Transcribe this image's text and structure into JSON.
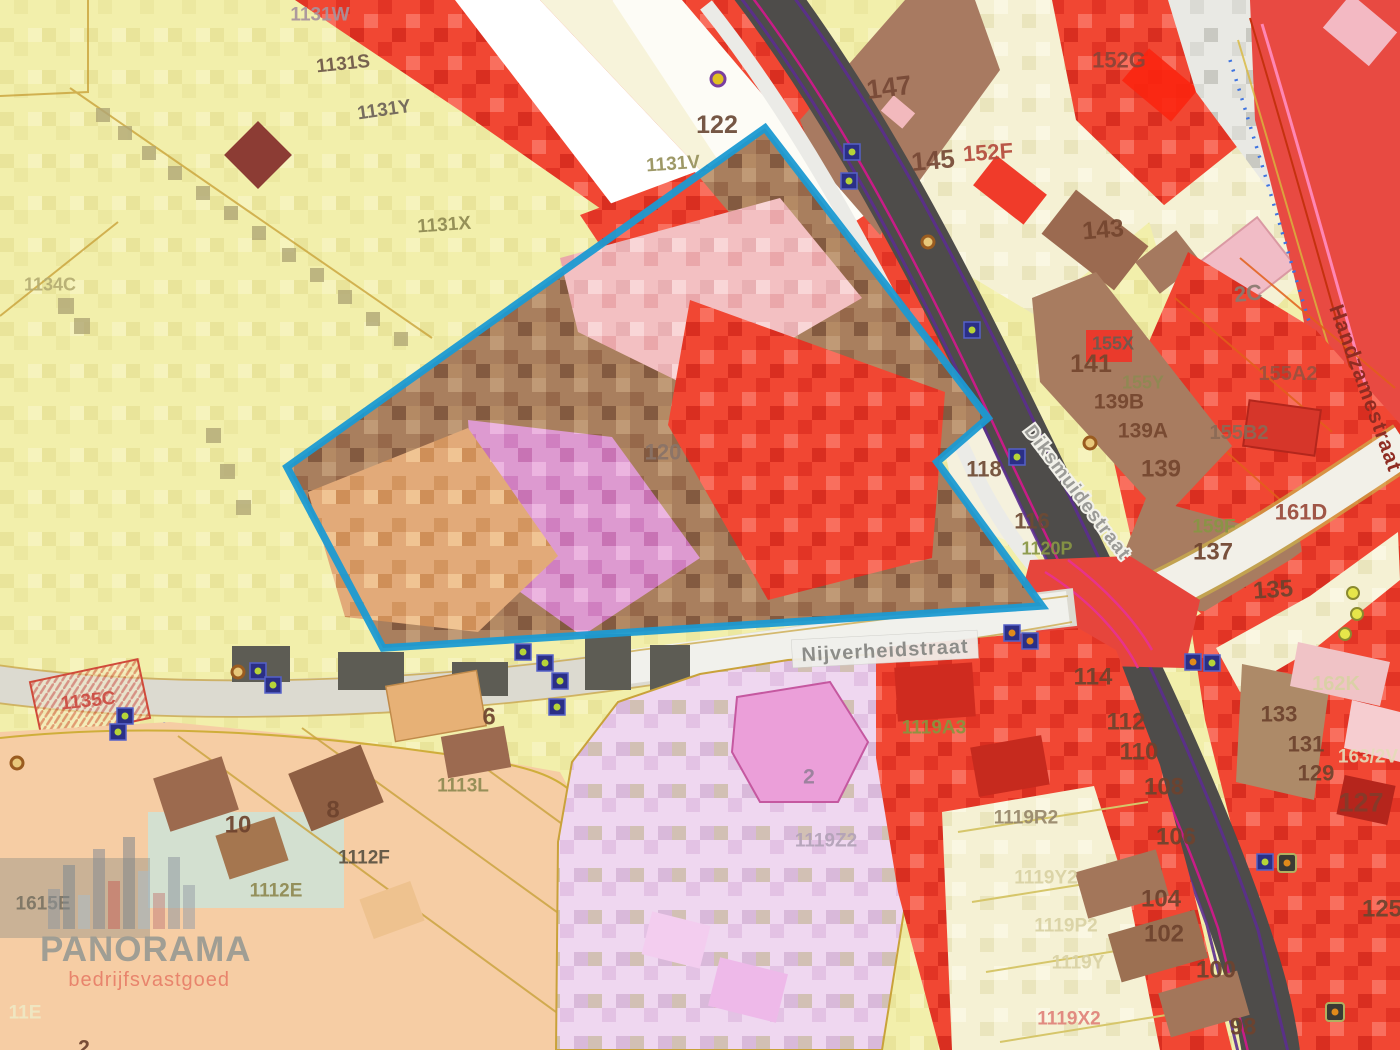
{
  "map": {
    "selection": {
      "color": "#1b9ad2",
      "points": "287,467 765,128 988,418 937,462 1042,606 383,648"
    },
    "streets": [
      {
        "name": "Nijverheidstraat",
        "x": 885,
        "y": 650,
        "rot": -3,
        "style": "pill",
        "color": "#8d8d89",
        "size": 20
      },
      {
        "name": "Diksmuidestraat",
        "x": 1078,
        "y": 492,
        "rot": 53,
        "style": "halo",
        "color": "#9b9b97",
        "size": 19
      },
      {
        "name": "Handzamestraat",
        "x": 1366,
        "y": 388,
        "rot": 70,
        "style": "plain",
        "color": "#8f2c22",
        "size": 21
      }
    ],
    "parcels": [
      {
        "label": "1131W",
        "x": 320,
        "y": 14,
        "size": 19,
        "color": "#a8929c"
      },
      {
        "label": "1131S",
        "x": 343,
        "y": 63,
        "size": 19,
        "color": "#6d5748",
        "rot": -6
      },
      {
        "label": "1131Y",
        "x": 384,
        "y": 109,
        "size": 19,
        "color": "#6d6258",
        "rot": -8
      },
      {
        "label": "1131X",
        "x": 444,
        "y": 224,
        "size": 19,
        "color": "#8f8a52",
        "rot": -4
      },
      {
        "label": "1131V",
        "x": 673,
        "y": 163,
        "size": 19,
        "color": "#96915c",
        "rot": -4
      },
      {
        "label": "122",
        "x": 717,
        "y": 124,
        "size": 25,
        "color": "#6b4a36"
      },
      {
        "label": "147",
        "x": 889,
        "y": 87,
        "size": 27,
        "color": "#774936",
        "rot": -7
      },
      {
        "label": "145",
        "x": 933,
        "y": 160,
        "size": 26,
        "color": "#774936",
        "rot": -5
      },
      {
        "label": "152F",
        "x": 988,
        "y": 152,
        "size": 22,
        "color": "#b44b3c",
        "rot": -4
      },
      {
        "label": "152G",
        "x": 1119,
        "y": 60,
        "size": 22,
        "color": "#8a4438"
      },
      {
        "label": "143",
        "x": 1103,
        "y": 229,
        "size": 25,
        "color": "#75462f",
        "rot": -5
      },
      {
        "label": "2C",
        "x": 1248,
        "y": 293,
        "size": 22,
        "color": "#897a70",
        "rot": -6
      },
      {
        "label": "155X",
        "x": 1113,
        "y": 343,
        "size": 18,
        "color": "#6a5c50"
      },
      {
        "label": "141",
        "x": 1091,
        "y": 363,
        "size": 25,
        "color": "#75462f"
      },
      {
        "label": "155Y",
        "x": 1143,
        "y": 382,
        "size": 18,
        "color": "#8f8a52"
      },
      {
        "label": "139B",
        "x": 1119,
        "y": 401,
        "size": 21,
        "color": "#75462f"
      },
      {
        "label": "155A2",
        "x": 1288,
        "y": 373,
        "size": 20,
        "color": "#9a5140"
      },
      {
        "label": "139A",
        "x": 1143,
        "y": 430,
        "size": 21,
        "color": "#75462f"
      },
      {
        "label": "155B2",
        "x": 1239,
        "y": 432,
        "size": 20,
        "color": "#8a6a56"
      },
      {
        "label": "139",
        "x": 1161,
        "y": 468,
        "size": 24,
        "color": "#75462f"
      },
      {
        "label": "161D",
        "x": 1301,
        "y": 512,
        "size": 22,
        "color": "#9a4a3a"
      },
      {
        "label": "159F",
        "x": 1214,
        "y": 526,
        "size": 19,
        "color": "#889644"
      },
      {
        "label": "137",
        "x": 1213,
        "y": 551,
        "size": 24,
        "color": "#6e432e"
      },
      {
        "label": "135",
        "x": 1273,
        "y": 589,
        "size": 24,
        "color": "#6e432e",
        "rot": -4
      },
      {
        "label": "118",
        "x": 984,
        "y": 469,
        "size": 22,
        "color": "#6e4a34"
      },
      {
        "label": "116",
        "x": 1032,
        "y": 521,
        "size": 22,
        "color": "#6e4a34"
      },
      {
        "label": "1120P",
        "x": 1047,
        "y": 548,
        "size": 18,
        "color": "#889644"
      },
      {
        "label": "120",
        "x": 663,
        "y": 452,
        "size": 22,
        "color": "#8a7468"
      },
      {
        "label": "114",
        "x": 1093,
        "y": 676,
        "size": 24,
        "color": "#6e432e"
      },
      {
        "label": "112",
        "x": 1126,
        "y": 721,
        "size": 24,
        "color": "#6e432e"
      },
      {
        "label": "110",
        "x": 1139,
        "y": 751,
        "size": 24,
        "color": "#6e432e"
      },
      {
        "label": "108",
        "x": 1164,
        "y": 786,
        "size": 24,
        "color": "#6e432e"
      },
      {
        "label": "106",
        "x": 1176,
        "y": 836,
        "size": 24,
        "color": "#6e432e"
      },
      {
        "label": "104",
        "x": 1161,
        "y": 898,
        "size": 24,
        "color": "#6e432e"
      },
      {
        "label": "102",
        "x": 1164,
        "y": 933,
        "size": 24,
        "color": "#6e432e"
      },
      {
        "label": "100",
        "x": 1216,
        "y": 969,
        "size": 24,
        "color": "#6e432e"
      },
      {
        "label": "98",
        "x": 1243,
        "y": 1026,
        "size": 24,
        "color": "#6e432e"
      },
      {
        "label": "125",
        "x": 1382,
        "y": 908,
        "size": 24,
        "color": "#6e432e"
      },
      {
        "label": "162K",
        "x": 1336,
        "y": 683,
        "size": 20,
        "color": "#d9d2a4"
      },
      {
        "label": "133",
        "x": 1279,
        "y": 714,
        "size": 22,
        "color": "#6e432e"
      },
      {
        "label": "131",
        "x": 1306,
        "y": 744,
        "size": 22,
        "color": "#6e432e"
      },
      {
        "label": "163/2V",
        "x": 1368,
        "y": 756,
        "size": 19,
        "color": "#e5dcba"
      },
      {
        "label": "129",
        "x": 1316,
        "y": 773,
        "size": 22,
        "color": "#6e432e"
      },
      {
        "label": "127",
        "x": 1361,
        "y": 802,
        "size": 27,
        "color": "#843b2b"
      },
      {
        "label": "1119A3",
        "x": 934,
        "y": 727,
        "size": 19,
        "color": "#88953f"
      },
      {
        "label": "1119R2",
        "x": 1026,
        "y": 817,
        "size": 19,
        "color": "#97876a"
      },
      {
        "label": "1119Y2",
        "x": 1046,
        "y": 877,
        "size": 19,
        "color": "#d9d2a4"
      },
      {
        "label": "1119P2",
        "x": 1066,
        "y": 925,
        "size": 19,
        "color": "#d9d2a4"
      },
      {
        "label": "1119Y",
        "x": 1078,
        "y": 962,
        "size": 19,
        "color": "#d9d2a4"
      },
      {
        "label": "1119X2",
        "x": 1069,
        "y": 1018,
        "size": 19,
        "color": "#e0837a"
      },
      {
        "label": "1119Z2",
        "x": 826,
        "y": 840,
        "size": 19,
        "color": "#b3a2b8"
      },
      {
        "label": "2",
        "x": 809,
        "y": 776,
        "size": 21,
        "color": "#97809a"
      },
      {
        "label": "1134C",
        "x": 50,
        "y": 284,
        "size": 18,
        "color": "#b5ad72"
      },
      {
        "label": "1135C",
        "x": 88,
        "y": 700,
        "size": 19,
        "color": "#cc4b41",
        "rot": -6
      },
      {
        "label": "10",
        "x": 238,
        "y": 824,
        "size": 24,
        "color": "#6e432e"
      },
      {
        "label": "8",
        "x": 333,
        "y": 809,
        "size": 24,
        "color": "#6e432e"
      },
      {
        "label": "6",
        "x": 489,
        "y": 716,
        "size": 24,
        "color": "#6e432e"
      },
      {
        "label": "1113L",
        "x": 463,
        "y": 785,
        "size": 19,
        "color": "#8f8a52"
      },
      {
        "label": "1112F",
        "x": 364,
        "y": 857,
        "size": 19,
        "color": "#5a5242"
      },
      {
        "label": "1112E",
        "x": 276,
        "y": 890,
        "size": 19,
        "color": "#8f8a52"
      },
      {
        "label": "1615E",
        "x": 43,
        "y": 903,
        "size": 19,
        "color": "#7b7464"
      },
      {
        "label": "11E",
        "x": 25,
        "y": 1012,
        "size": 19,
        "color": "#efe9c4"
      },
      {
        "label": "2",
        "x": 84,
        "y": 1047,
        "size": 21,
        "color": "#6e432e"
      }
    ],
    "markers": [
      {
        "type": "square",
        "x": 852,
        "y": 152
      },
      {
        "type": "square",
        "x": 849,
        "y": 181
      },
      {
        "type": "square",
        "x": 972,
        "y": 330
      },
      {
        "type": "square",
        "x": 1017,
        "y": 457
      },
      {
        "type": "square",
        "x": 523,
        "y": 652
      },
      {
        "type": "square",
        "x": 545,
        "y": 663
      },
      {
        "type": "square",
        "x": 560,
        "y": 681
      },
      {
        "type": "square",
        "x": 557,
        "y": 707
      },
      {
        "type": "square",
        "x": 125,
        "y": 716
      },
      {
        "type": "square",
        "x": 118,
        "y": 732
      },
      {
        "type": "square",
        "x": 258,
        "y": 671
      },
      {
        "type": "square",
        "x": 273,
        "y": 685
      },
      {
        "type": "square",
        "x": 1212,
        "y": 663
      },
      {
        "type": "square",
        "x": 1265,
        "y": 862
      },
      {
        "type": "square-orange",
        "x": 1012,
        "y": 633
      },
      {
        "type": "square-orange",
        "x": 1030,
        "y": 641
      },
      {
        "type": "square-orange",
        "x": 1193,
        "y": 662
      },
      {
        "type": "circle-purple",
        "x": 718,
        "y": 79
      },
      {
        "type": "circle-brown",
        "x": 928,
        "y": 242
      },
      {
        "type": "circle-brown",
        "x": 1090,
        "y": 443
      },
      {
        "type": "circle-brown",
        "x": 238,
        "y": 672
      },
      {
        "type": "circle-brown",
        "x": 17,
        "y": 763
      },
      {
        "type": "circle-yellow",
        "x": 1353,
        "y": 593
      },
      {
        "type": "circle-yellow",
        "x": 1357,
        "y": 614
      },
      {
        "type": "circle-yellow",
        "x": 1345,
        "y": 634
      },
      {
        "type": "bolt",
        "x": 1287,
        "y": 863
      },
      {
        "type": "bolt",
        "x": 1335,
        "y": 1012
      }
    ],
    "watermark": {
      "title": "PANORAMA",
      "subtitle": "bedrijfsvastgoed",
      "bars": [
        {
          "h": 40,
          "c": "#8f979e"
        },
        {
          "h": 64,
          "c": "#7d8890"
        },
        {
          "h": 34,
          "c": "#a9bcc7"
        },
        {
          "h": 80,
          "c": "#868d93"
        },
        {
          "h": 48,
          "c": "#c4665c"
        },
        {
          "h": 92,
          "c": "#7f868c"
        },
        {
          "h": 58,
          "c": "#a9bcc7"
        },
        {
          "h": 36,
          "c": "#c4837b"
        },
        {
          "h": 72,
          "c": "#8f979e"
        },
        {
          "h": 44,
          "c": "#99a1a8"
        }
      ]
    }
  }
}
